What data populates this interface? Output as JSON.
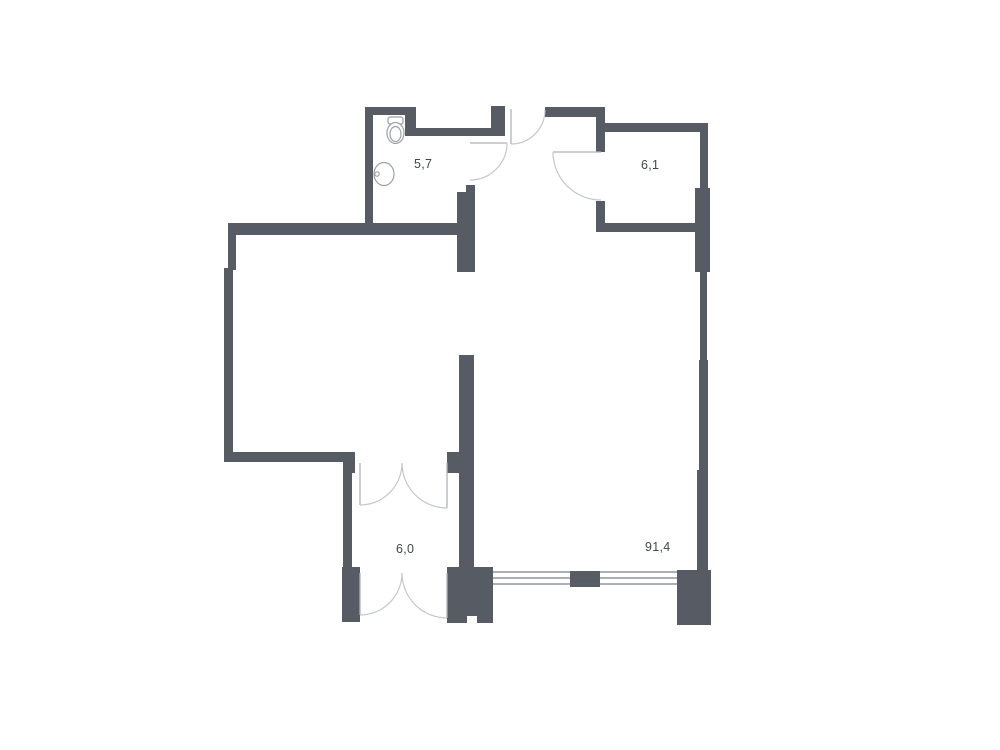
{
  "plan": {
    "type": "apartment-floor-plan",
    "background": "#ffffff",
    "colors": {
      "background": "#ffffff",
      "wall": "#565b64",
      "window_line": "#5a5f68",
      "door_arc": "#c3c7cd",
      "door_leaf": "#aeb2ba",
      "fixture": "#9aa0a8",
      "label": "#41454d"
    },
    "rooms": [
      {
        "name": "bathroom",
        "area": "5,7"
      },
      {
        "name": "storage",
        "area": "6,1"
      },
      {
        "name": "lower-room",
        "area": "6,0"
      },
      {
        "name": "living-space",
        "area": "91,4"
      }
    ],
    "fixtures": [
      "toilet-icon",
      "sink-icon"
    ],
    "features": [
      "entry-door",
      "bathroom-door",
      "storage-door",
      "double-door-upper",
      "double-door-lower",
      "window-with-mullion",
      "open-passage"
    ]
  }
}
